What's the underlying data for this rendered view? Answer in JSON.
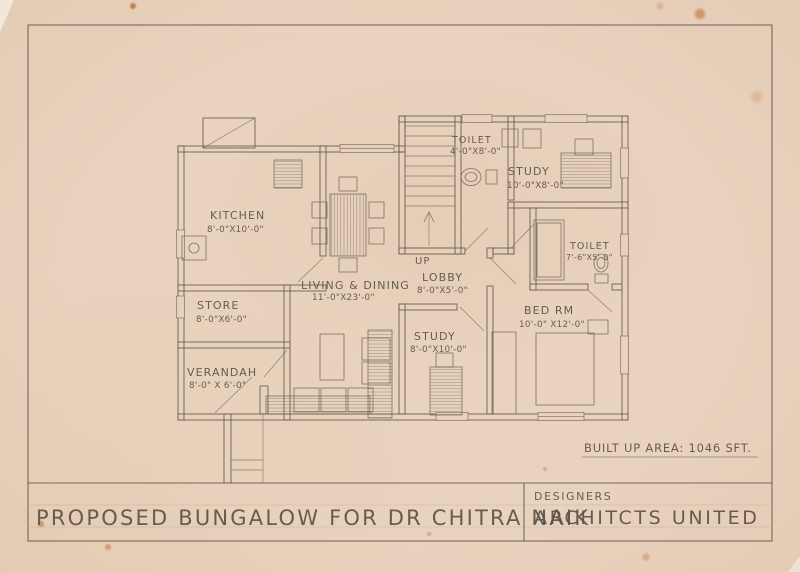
{
  "colors": {
    "paper": "#e9d3be",
    "pencil": "#665d51",
    "stain": "#b96a33"
  },
  "plan": {
    "rooms": [
      {
        "name": "KITCHEN",
        "dims": "8'-0\"X10'-0\""
      },
      {
        "name": "STORE",
        "dims": "8'-0\"X6'-0\""
      },
      {
        "name": "VERANDAH",
        "dims": "8'-0\" X 6'-0\""
      },
      {
        "name": "LIVING & DINING",
        "dims": "11'-0\"X23'-0\""
      },
      {
        "name": "LOBBY",
        "dims": "8'-0\"X5'-0\""
      },
      {
        "name": "TOILET",
        "dims": "4'-0\"X8'-0\""
      },
      {
        "name": "STUDY",
        "dims": "10'-0\"X8'-0\""
      },
      {
        "name": "TOILET",
        "dims": "7'-6\"X5'-0\""
      },
      {
        "name": "BED RM",
        "dims": "10'-0\" X12'-0\""
      },
      {
        "name": "STUDY",
        "dims": "8'-0\"X10'-0\""
      }
    ],
    "stair_label": "UP",
    "area_note": "BUILT UP AREA: 1046 SFT."
  },
  "title_block": {
    "project_title": "PROPOSED BUNGALOW FOR DR CHITRA NAIK",
    "firm_line1": "DESIGNERS",
    "firm_line2": "ARCHITCTS UNITED"
  }
}
